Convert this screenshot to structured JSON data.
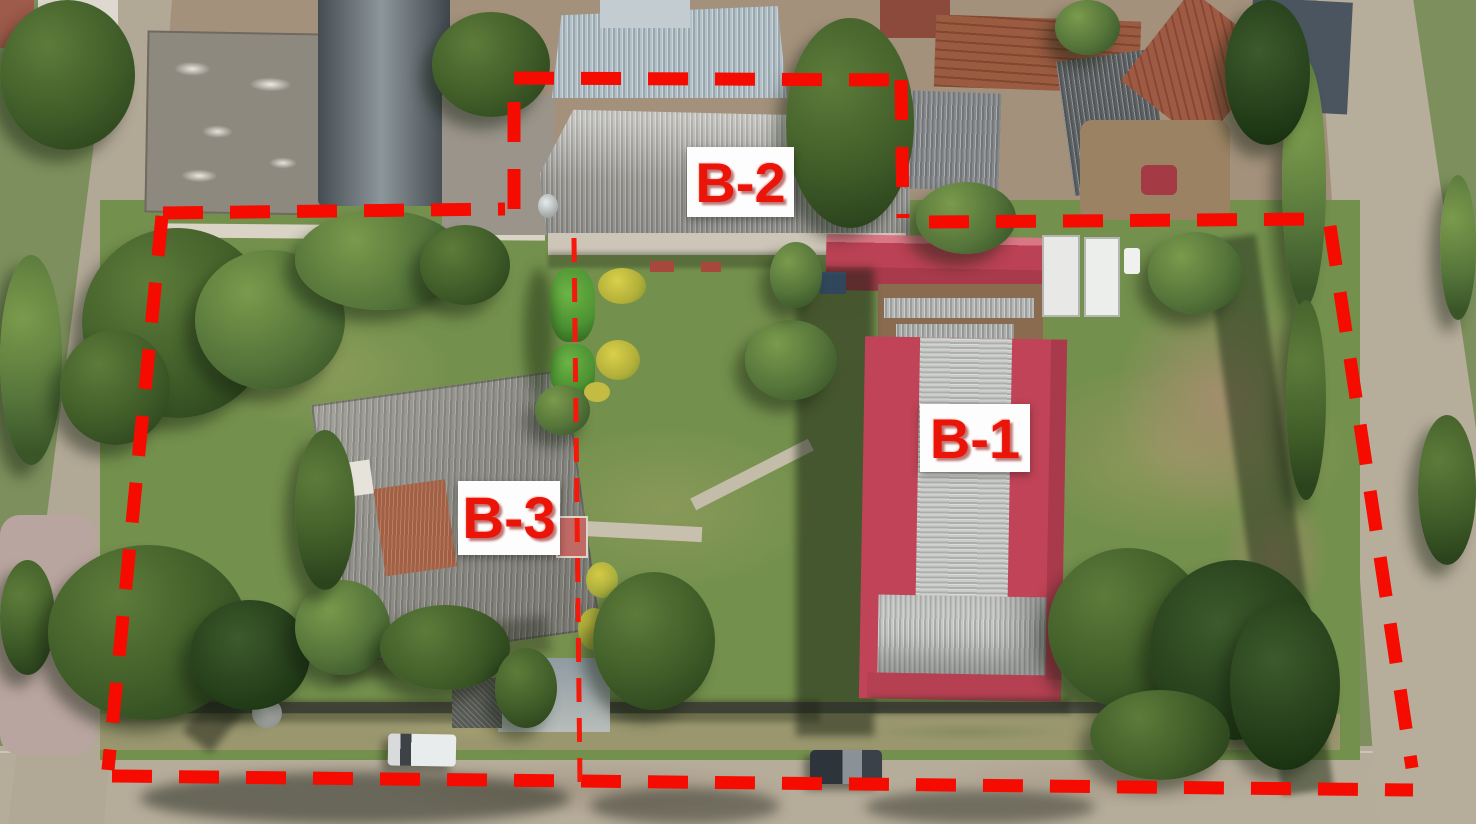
{
  "image_type": "aerial drone photograph with property boundary annotations",
  "annotations": {
    "boundary": {
      "color": "#f60b00",
      "style": "thick dashed line",
      "thickness_px": 13,
      "dash_px": 40,
      "gap_px": 27
    },
    "divider": {
      "color": "#f3190b",
      "style": "thin dashed line",
      "thickness_px": 5
    },
    "label_style": {
      "text_color": "#ea1408",
      "background": "#ffffff"
    },
    "labels": {
      "b1": {
        "text": "B-1"
      },
      "b2": {
        "text": "B-2"
      },
      "b3": {
        "text": "B-3"
      }
    }
  },
  "scene": {
    "features": [
      "large red-roof hall labeled B-1",
      "gray corrugated warehouse labeled B-2",
      "gray hip-roof house labeled B-3",
      "lawn with trees, hedges and yellow bushes",
      "streets on left, right and bottom edges",
      "white pickup and dark SUV parked on bottom street",
      "two white box trucks parked beside B-1",
      "neighboring tile-roof houses along the top"
    ]
  }
}
